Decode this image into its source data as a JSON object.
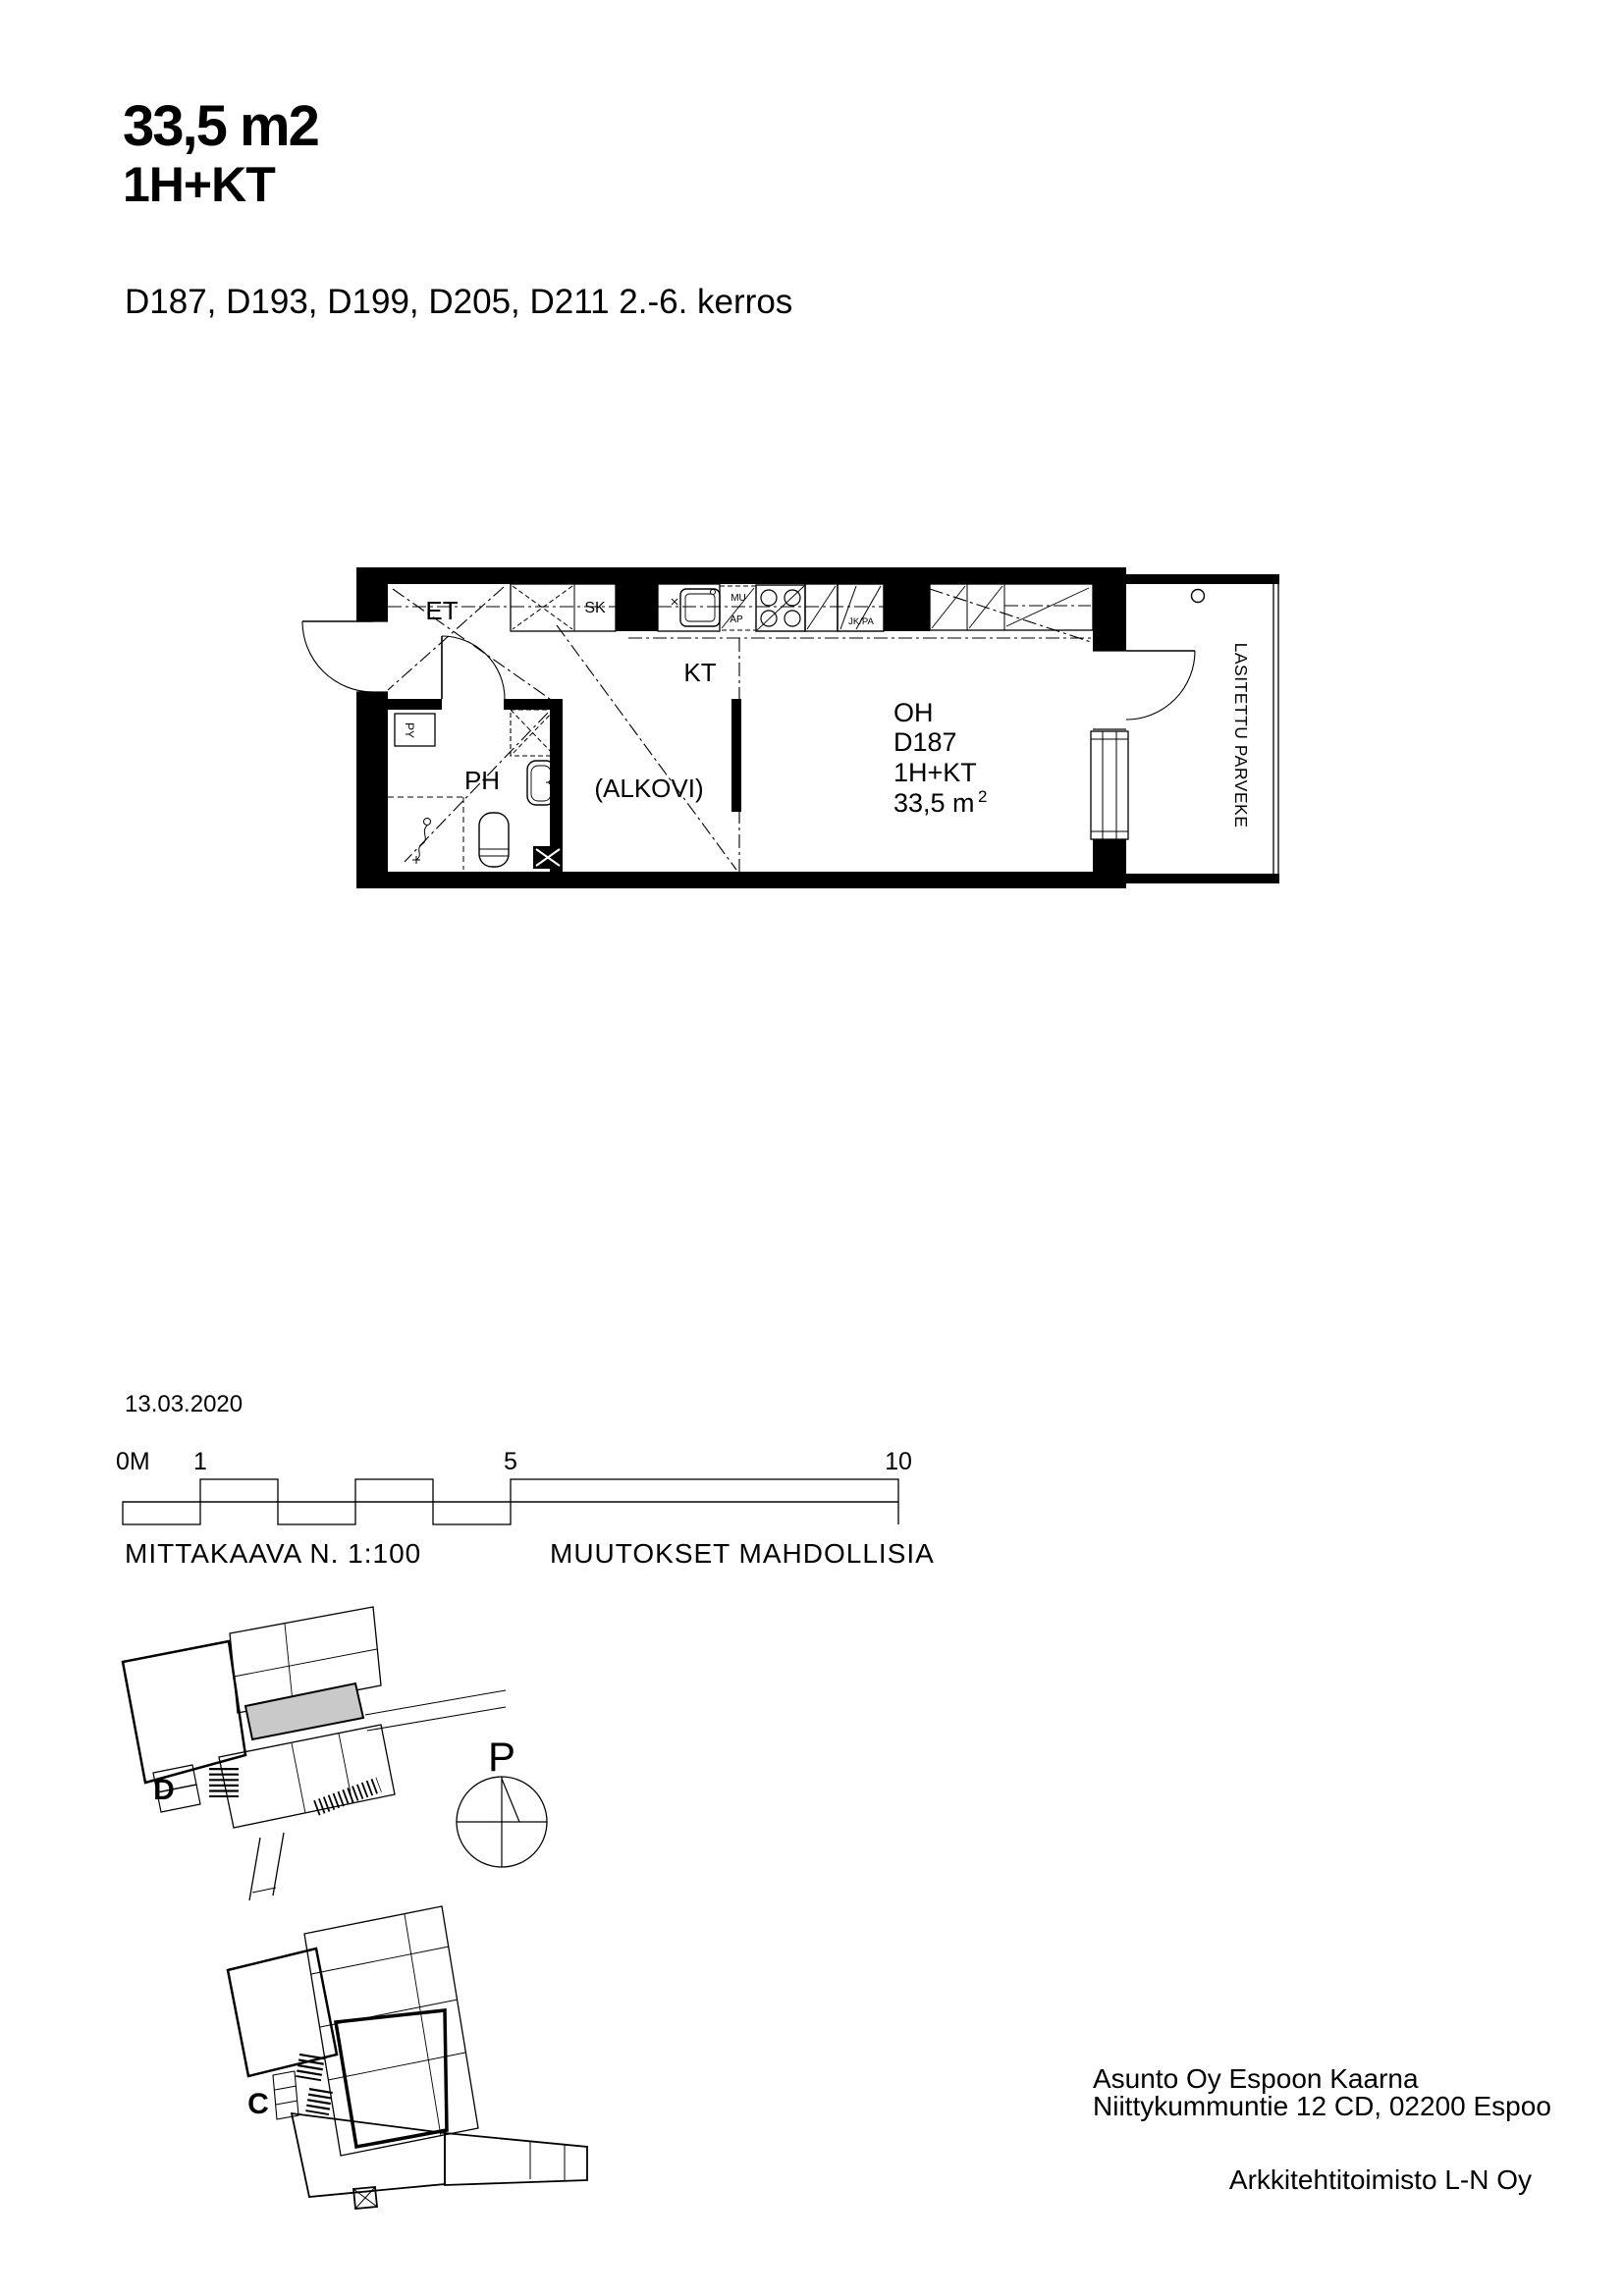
{
  "header": {
    "title_area": "33,5 m2",
    "title_type": "1H+KT",
    "subtitle": "D187, D193, D199, D205, D211 2.-6. kerros"
  },
  "plan": {
    "entry": "ET",
    "closet": "SK",
    "kitchen": "KT",
    "alcove": "(ALKOVI)",
    "bath": "PH",
    "laundry": "PY",
    "micro": "MU",
    "dishwasher": "AP",
    "fridge": "JK/PA",
    "living": "OH",
    "unit_id": "D187",
    "unit_type": "1H+KT",
    "unit_area": "33,5 m",
    "unit_area_sup": "2",
    "balcony": "LASITETTU PARVEKE"
  },
  "scalebar": {
    "date": "13.03.2020",
    "t0": "0M",
    "t1": "1",
    "t5": "5",
    "t10": "10",
    "scale_note": "MITTAKAAVA N. 1:100",
    "changes_note": "MUUTOKSET MAHDOLLISIA"
  },
  "siteplan": {
    "building_d": "D",
    "building_c": "C",
    "north": "P"
  },
  "footer": {
    "company": "Asunto Oy Espoon Kaarna",
    "address": "Niittykummuntie 12 CD, 02200 Espoo",
    "architect": "Arkkitehtitoimisto L-N Oy"
  },
  "colors": {
    "ink": "#000000",
    "highlight": "#c9c9c9"
  }
}
